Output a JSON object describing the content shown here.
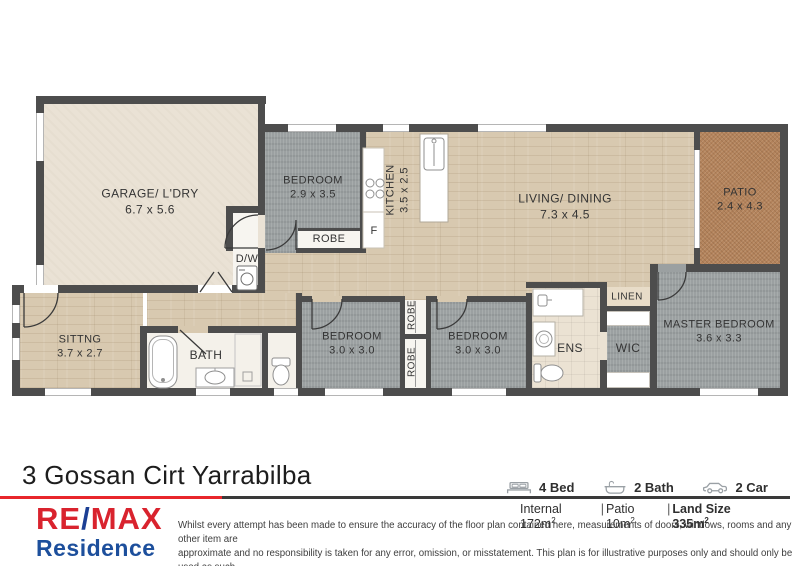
{
  "floorplan": {
    "rooms": {
      "garage": {
        "name": "GARAGE/ L'DRY",
        "dims": "6.7 x 5.6"
      },
      "bedroom2": {
        "name": "BEDROOM",
        "dims": "2.9 x 3.5"
      },
      "kitchen": {
        "name": "KITCHEN",
        "dims": "3.5 x 2.5"
      },
      "living": {
        "name": "LIVING/ DINING",
        "dims": "7.3 x 4.5"
      },
      "patio": {
        "name": "PATIO",
        "dims": "2.4 x 4.3"
      },
      "robe_top": {
        "name": "ROBE"
      },
      "fridge": {
        "name": "F"
      },
      "dishwasher": {
        "name": "D/W"
      },
      "sitting": {
        "name": "SITTNG",
        "dims": "3.7 x 2.7"
      },
      "bath": {
        "name": "BATH"
      },
      "bedroom3": {
        "name": "BEDROOM",
        "dims": "3.0 x 3.0"
      },
      "robe_mid_top": {
        "name": "ROBE"
      },
      "robe_mid_bottom": {
        "name": "ROBE"
      },
      "bedroom4": {
        "name": "BEDROOM",
        "dims": "3.0 x 3.0"
      },
      "ens": {
        "name": "ENS"
      },
      "linen": {
        "name": "LINEN"
      },
      "wic": {
        "name": "WIC"
      },
      "master": {
        "name": "MASTER BEDROOM",
        "dims": "3.6 x 3.3"
      }
    }
  },
  "footer": {
    "title": "3 Gossan Cirt Yarrabilba",
    "features": [
      {
        "icon": "bed-icon",
        "label": "4 Bed"
      },
      {
        "icon": "bath-icon",
        "label": "2 Bath"
      },
      {
        "icon": "car-icon",
        "label": "2 Car"
      }
    ],
    "areas": [
      {
        "text": "Internal 172m",
        "sup": "2"
      },
      {
        "text": "Patio 10m",
        "sup": "2"
      },
      {
        "text": "Land Size 335m",
        "sup": "2"
      }
    ],
    "separator": "|",
    "brand": {
      "re": "RE",
      "slash": "/",
      "max": "MAX",
      "sub": "Residence"
    },
    "disclaimer_lines": [
      "Whilst every attempt has been made to ensure the accuracy of the floor plan contained here, measurements of doors, windows, rooms and any other item are",
      "approximate and no responsibility is taken for any error, omission, or misstatement. This plan is for illustrative purposes only and should only be used as such",
      "by any prospective purchaser."
    ]
  },
  "colors": {
    "wall": "#4d4d4d",
    "wood": "#d8c9b0",
    "carpet": "#9ba0a1",
    "patio": "#b3835c",
    "garage_floor": "#eae2d5",
    "brand_red": "#d9232e",
    "brand_blue": "#1d4f9c",
    "divider_red": "#e8262b",
    "divider_dark": "#3a3a3a"
  }
}
